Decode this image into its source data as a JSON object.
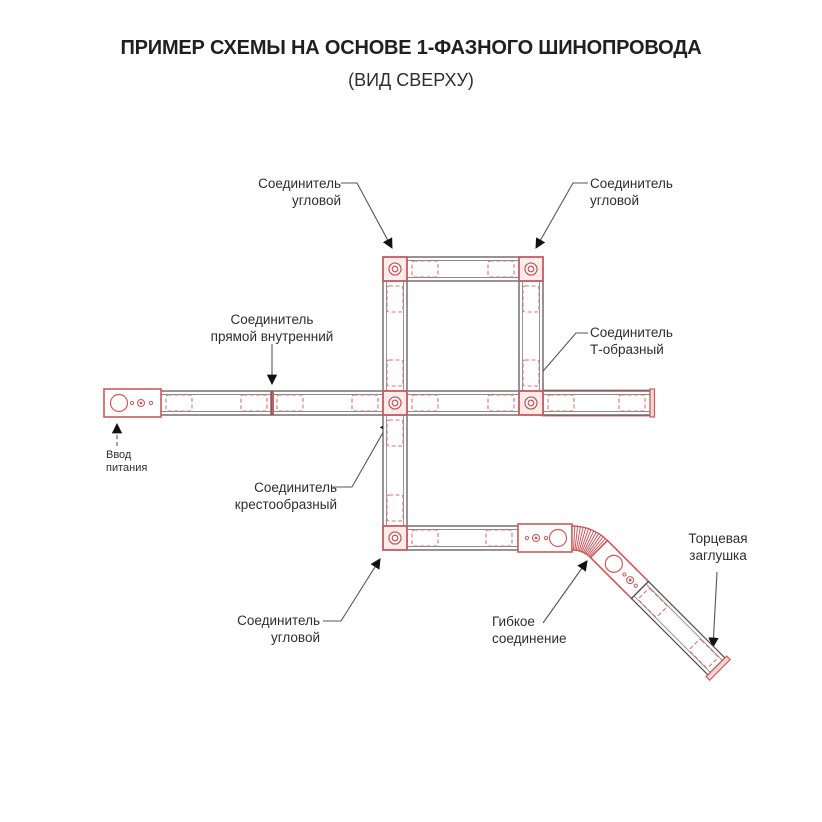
{
  "title": "ПРИМЕР СХЕМЫ НА ОСНОВЕ 1-ФАЗНОГО ШИНОПРОВОДА",
  "subtitle": "(ВИД СВЕРХУ)",
  "colors": {
    "accent_red": "#c75b5e",
    "dash_red": "#d47578",
    "line_dark": "#4d4d4d",
    "leader_gray": "#555555",
    "text": "#2e2e2e"
  },
  "labels": {
    "corner_top_left": {
      "line1": "Соединитель",
      "line2": "угловой"
    },
    "corner_top_right": {
      "line1": "Соединитель",
      "line2": "угловой"
    },
    "straight_internal": {
      "line1": "Соединитель",
      "line2": "прямой внутренний"
    },
    "tee": {
      "line1": "Соединитель",
      "line2": "Т-образный"
    },
    "power_input": {
      "line1": "Ввод",
      "line2": "питания"
    },
    "cross": {
      "line1": "Соединитель",
      "line2": "крестообразный"
    },
    "corner_bottom": {
      "line1": "Соединитель",
      "line2": "угловой"
    },
    "flexible": {
      "line1": "Гибкое",
      "line2": "соединение"
    },
    "end_cap": {
      "line1": "Торцевая",
      "line2": "заглушка"
    }
  }
}
